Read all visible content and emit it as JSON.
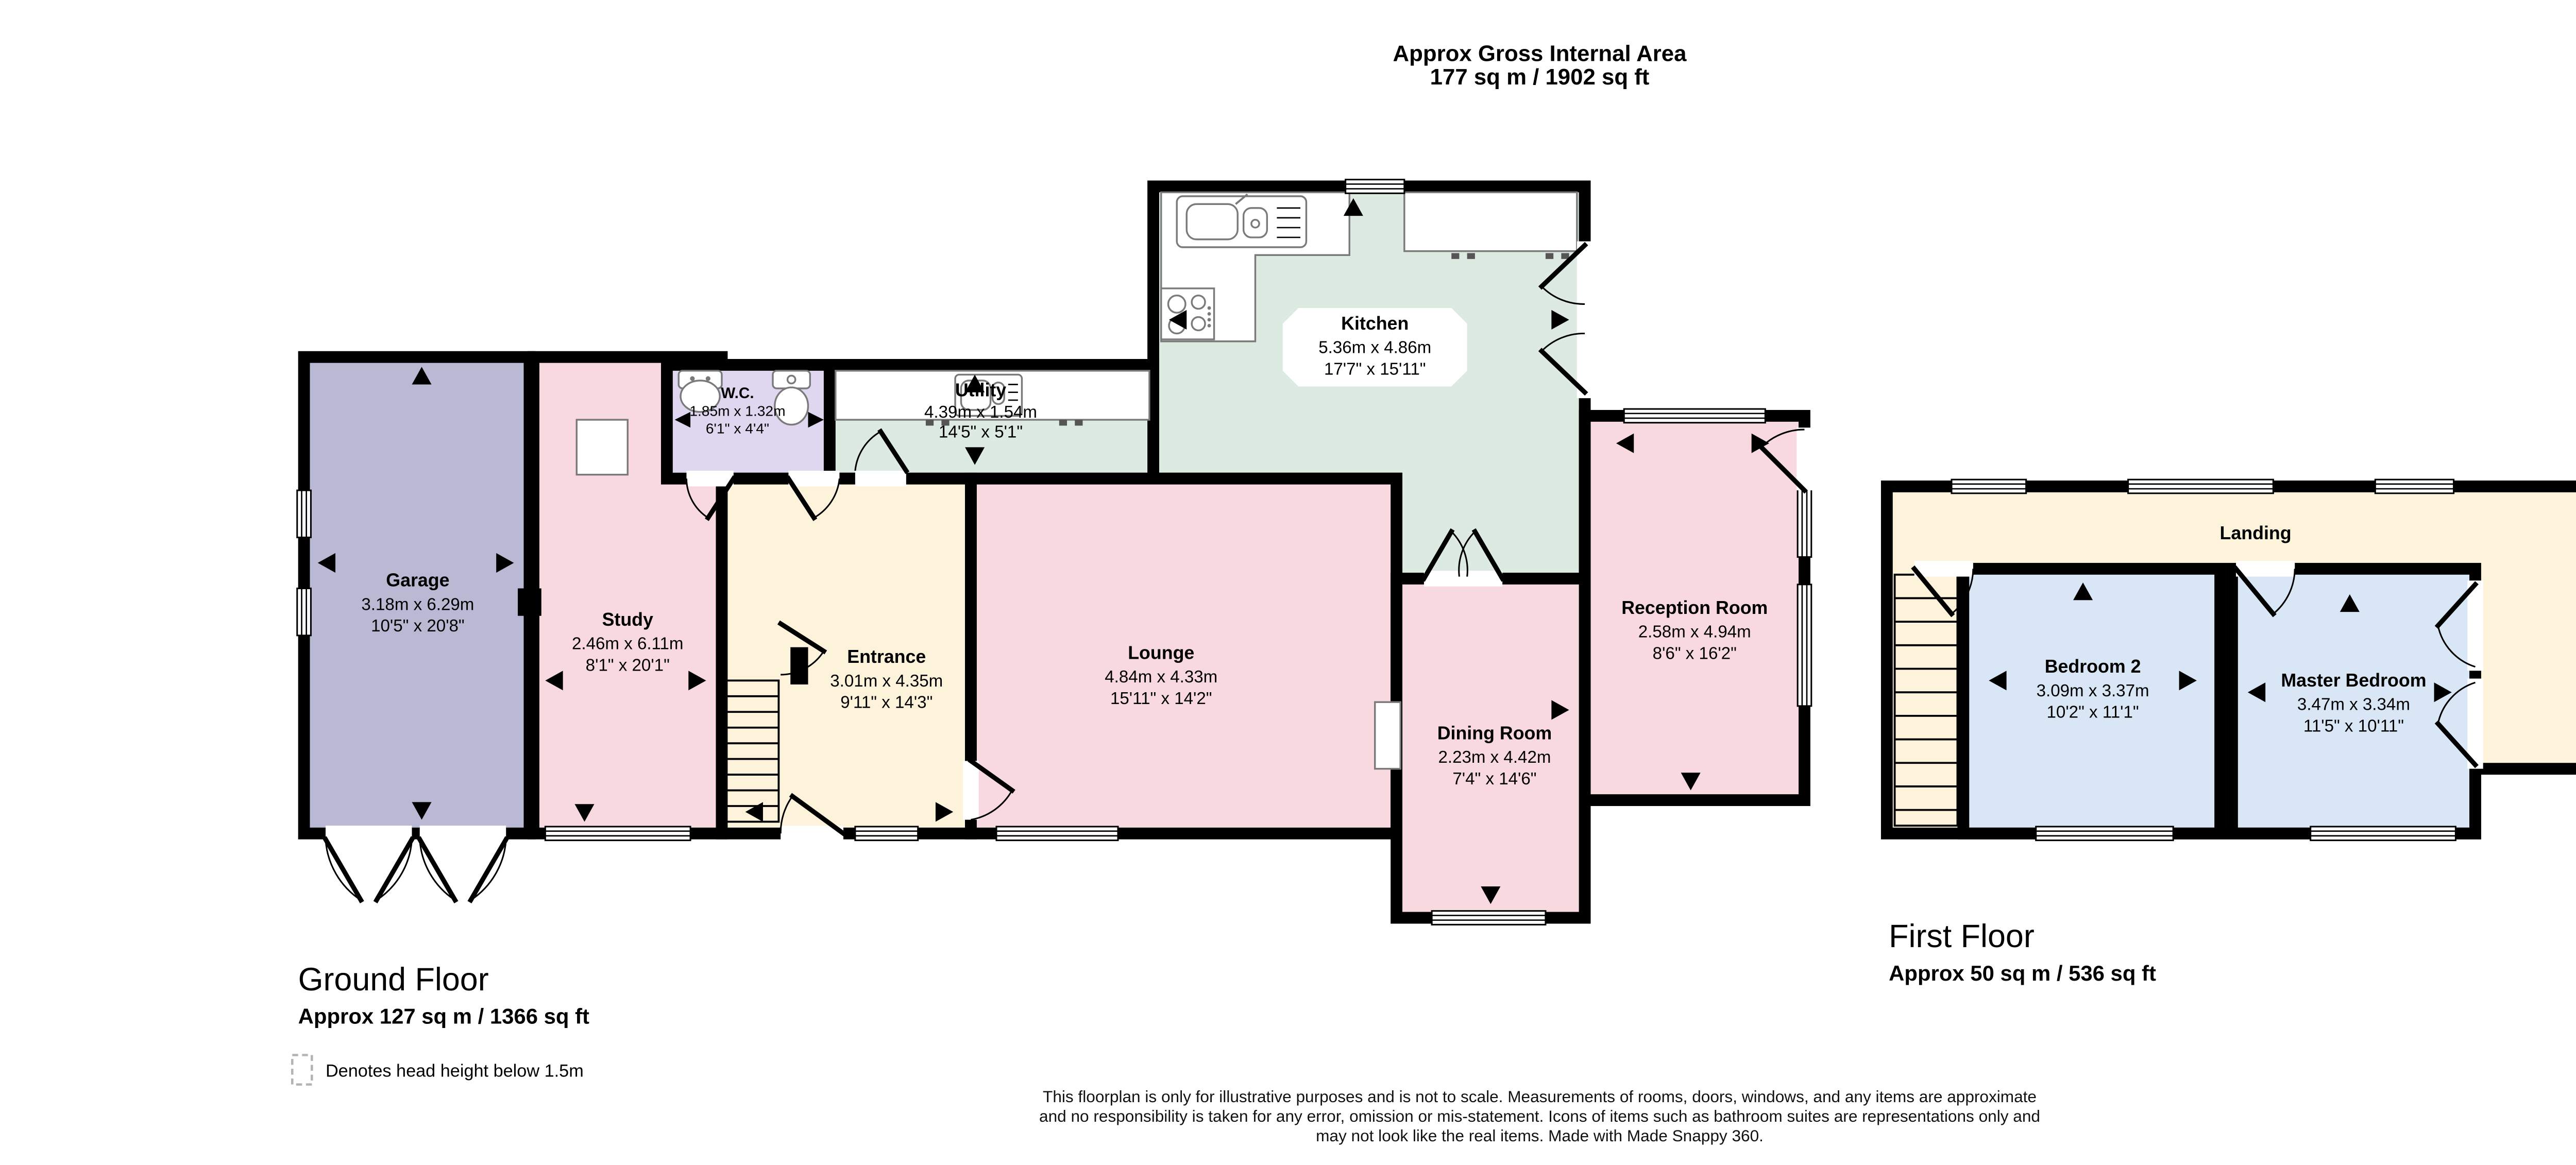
{
  "header": {
    "title_line1": "Approx Gross Internal Area",
    "title_line2": "177 sq m / 1902 sq ft"
  },
  "colors": {
    "wall": "#000000",
    "pink": "#f9d9e0",
    "green": "#dceae1",
    "cream": "#fdf3da",
    "purple": "#b9b9d4",
    "lavender": "#ded7ef",
    "blue": "#d8e6f5",
    "dashed_gray": "#b3b3b3",
    "white": "#ffffff"
  },
  "ground_floor": {
    "title": "Ground Floor",
    "area": "Approx 127 sq m / 1366 sq ft",
    "rooms": [
      {
        "name": "Garage",
        "metric": "3.18m x 6.29m",
        "imperial": "10'5\" x 20'8\""
      },
      {
        "name": "Study",
        "metric": "2.46m x 6.11m",
        "imperial": "8'1\" x 20'1\""
      },
      {
        "name": "W.C.",
        "metric": "1.85m x 1.32m",
        "imperial": "6'1\" x 4'4\""
      },
      {
        "name": "Utility",
        "metric": "4.39m x 1.54m",
        "imperial": "14'5\" x 5'1\""
      },
      {
        "name": "Kitchen",
        "metric": "5.36m x 4.86m",
        "imperial": "17'7\" x 15'11\""
      },
      {
        "name": "Entrance",
        "metric": "3.01m x 4.35m",
        "imperial": "9'11\" x 14'3\""
      },
      {
        "name": "Lounge",
        "metric": "4.84m x 4.33m",
        "imperial": "15'11\" x 14'2\""
      },
      {
        "name": "Reception Room",
        "metric": "2.58m x 4.94m",
        "imperial": "8'6\" x 16'2\""
      },
      {
        "name": "Dining Room",
        "metric": "2.23m x 4.42m",
        "imperial": "7'4\" x 14'6\""
      }
    ]
  },
  "first_floor": {
    "title": "First Floor",
    "area": "Approx 50 sq m / 536 sq ft",
    "rooms": [
      {
        "name": "Landing",
        "metric": "",
        "imperial": ""
      },
      {
        "name": "Bedroom 2",
        "metric": "3.09m x 3.37m",
        "imperial": "10'2\" x 11'1\""
      },
      {
        "name": "Master Bedroom",
        "metric": "3.47m x 3.34m",
        "imperial": "11'5\" x 10'11\""
      },
      {
        "name": "Storage Room",
        "metric": "2.17m x 2.04m",
        "imperial": "7'1\" x 6'8\""
      },
      {
        "name": "Shower Room",
        "metric": "2.13m x 3.90m",
        "imperial": "7'0\" x 12'10\""
      }
    ]
  },
  "legend": {
    "text": "Denotes head height below 1.5m"
  },
  "footer": {
    "line1": "This floorplan is only for illustrative purposes and is not to scale. Measurements of rooms, doors, windows, and any items are approximate",
    "line2": "and no responsibility is taken for any error, omission or mis-statement. Icons of items such as bathroom suites are representations only and",
    "line3": "may not look like the real items. Made with Made Snappy 360."
  },
  "icons": {
    "sink": "sink-icon",
    "hob": "hob-icon",
    "toilet": "toilet-icon",
    "bath": "bath-icon",
    "stairs": "stairs-icon",
    "fireplace": "fireplace-icon",
    "window": "window-icon",
    "door": "door-arc-icon",
    "arrow": "measurement-arrow-icon"
  }
}
